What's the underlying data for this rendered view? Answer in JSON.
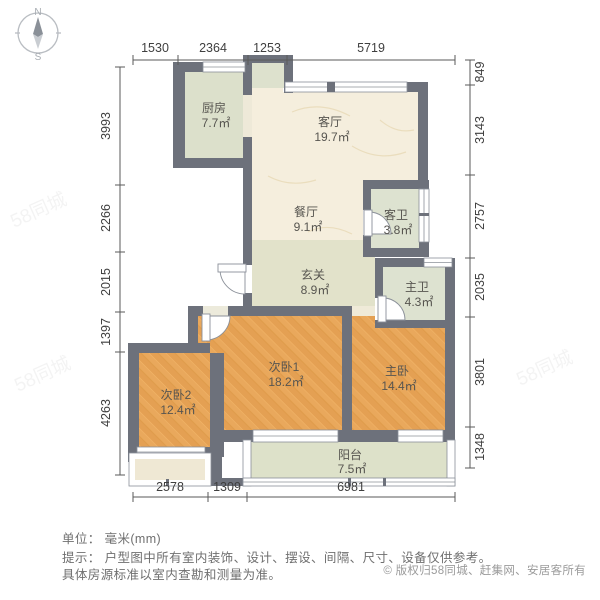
{
  "compass": {
    "north": "N",
    "south": "S"
  },
  "rooms": {
    "kitchen": {
      "name": "厨房",
      "area": "7.7㎡"
    },
    "living": {
      "name": "客厅",
      "area": "19.7㎡"
    },
    "dining": {
      "name": "餐厅",
      "area": "9.1㎡"
    },
    "guest_bath": {
      "name": "客卫",
      "area": "3.8㎡"
    },
    "entry": {
      "name": "玄关",
      "area": "8.9㎡"
    },
    "master_bath": {
      "name": "主卫",
      "area": "4.3㎡"
    },
    "bedroom1": {
      "name": "次卧1",
      "area": "18.2㎡"
    },
    "bedroom2": {
      "name": "次卧2",
      "area": "12.4㎡"
    },
    "master": {
      "name": "主卧",
      "area": "14.4㎡"
    },
    "balcony": {
      "name": "阳台",
      "area": "7.5㎡"
    }
  },
  "dimensions": {
    "top": [
      "1530",
      "2364",
      "1253",
      "5719"
    ],
    "left": [
      "3993",
      "2266",
      "2015",
      "1397",
      "4263"
    ],
    "right": [
      "849",
      "3143",
      "2757",
      "2035",
      "3801",
      "1348"
    ],
    "bottom": [
      "2578",
      "1309",
      "6981"
    ]
  },
  "footer": {
    "unit_line": "单位： 毫米(mm)",
    "hint_line1": "提示： 户型图中所有室内装饰、设计、摆设、间隔、尺寸、设备仅供参考。",
    "hint_line2": "具体房源标准以室内查勘和测量为准。",
    "copyright": "© 版权归58同城、赶集网、安居客所有"
  },
  "watermark": "58同城",
  "colors": {
    "wall": "#6d717b",
    "wood_floor": "#e9a85c",
    "tile_floor": "#dde1cc",
    "marble_floor": "#f5eedd",
    "window_frame": "#ffffff",
    "dim_text": "#3f3f3f"
  }
}
